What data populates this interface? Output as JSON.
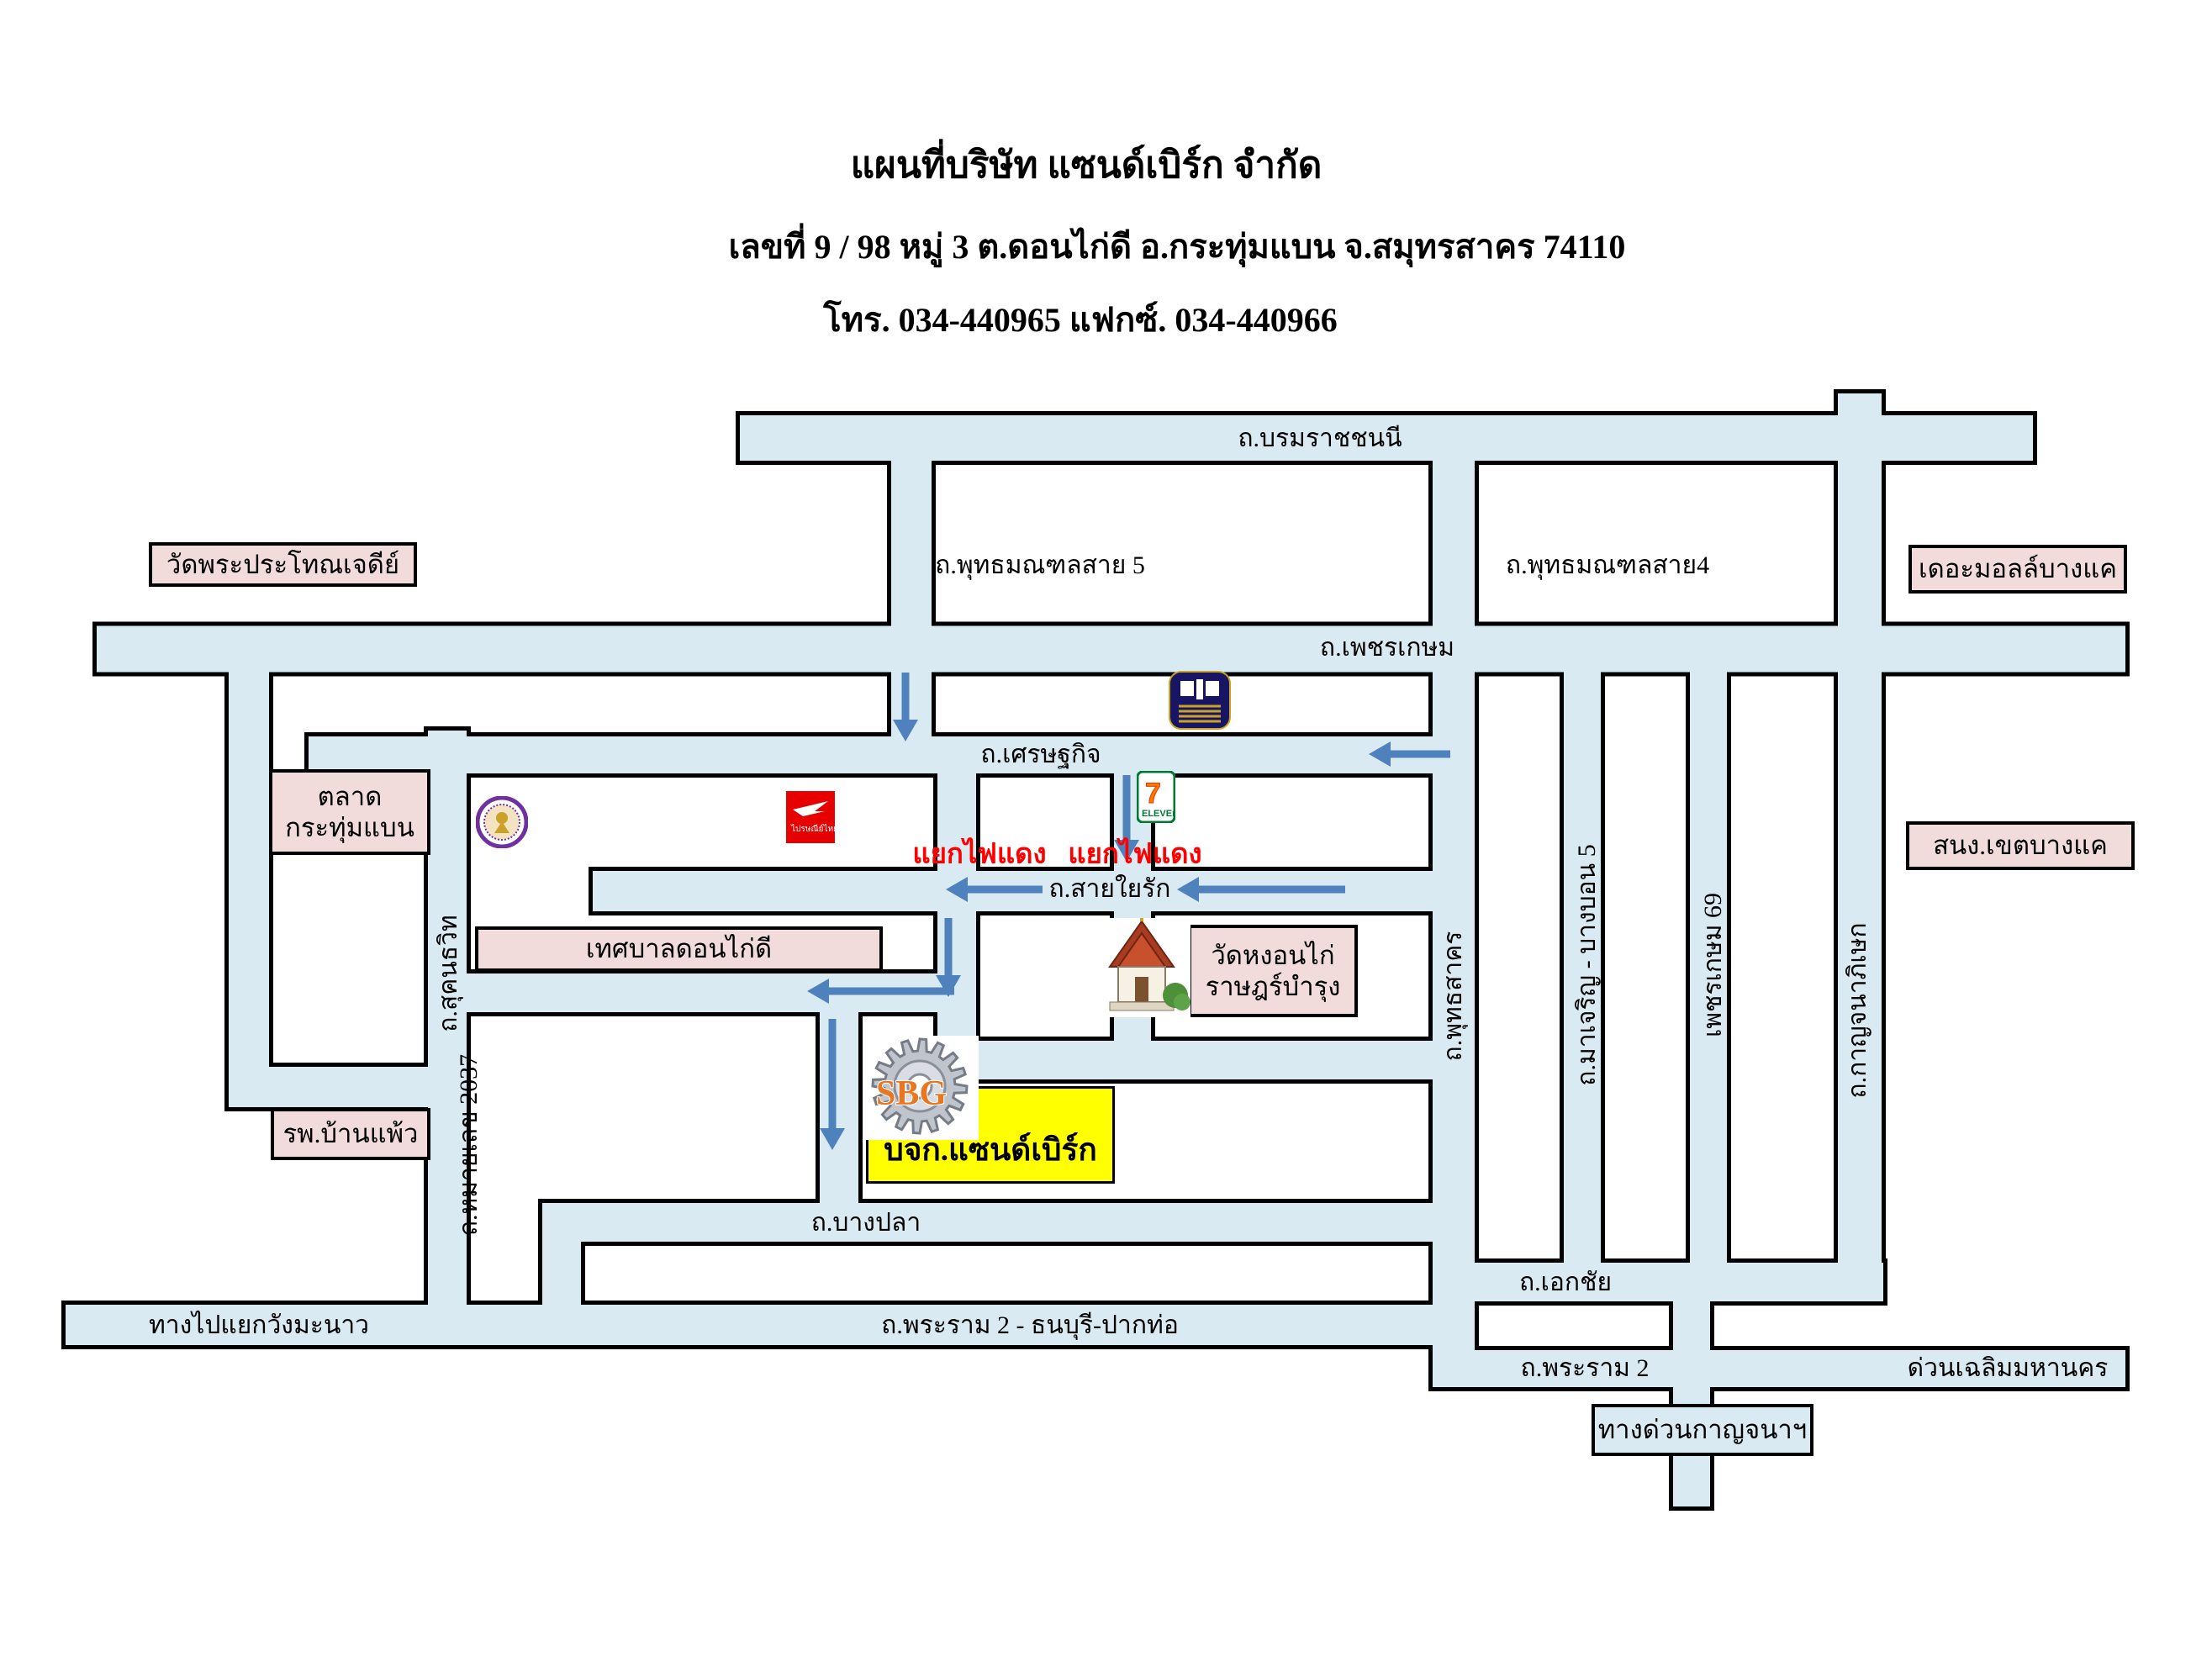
{
  "page": {
    "title_line1": "แผนที่บริษัท แซนด์เบิร์ก จำกัด",
    "title_line2": "เลขที่ 9 / 98   หมู่ 3   ต.ดอนไก่ดี  อ.กระทุ่มแบน  จ.สมุทรสาคร   74110",
    "title_line3": "โทร. 034-440965        แฟกซ์. 034-440966"
  },
  "company": {
    "name": "บจก.แซนด์เบิร์ก",
    "logo_text": "SBG"
  },
  "roads": {
    "borommaratchachonnani": "ถ.บรมราชชนนี",
    "phutthamonthon_sai5": "ถ.พุทธมณฑลสาย 5",
    "phutthamonthon_sai4": "ถ.พุทธมณฑลสาย4",
    "phetkasem": "ถ.เพชรเกษม",
    "setthakit": "ถ.เศรษฐกิจ",
    "saiyairak": "ถ.สายใยรัก",
    "bangpla": "ถ.บางปลา",
    "rama2_thonburi": "ถ.พระราม 2 - ธนบุรี-ปากท่อ",
    "wangmanao": "ทางไปแยกวังมะนาว",
    "ekkachai": "ถ.เอกชัย",
    "rama2": "ถ.พระราม 2",
    "chalerm_mahanakhon": "ด่วนเฉลิมมหานคร",
    "sukhonthawit": "ถ.สุคนธวิท",
    "highway2037": "ถ.หมายเลข 2037",
    "phutthasakhon": "ถ.พุทธสาคร",
    "macharoen": "ถ.มาเจริญ - บางบอน 5",
    "phetkasem69": "เพชรเกษม 69",
    "kanchanaphisek": "ถ.กาญจนาภิเษก"
  },
  "places": {
    "wat_phra_prathon": "วัดพระประโทณเจดีย์",
    "talat_line1": "ตลาด",
    "talat_line2": "กระทุ่มแบน",
    "thesaban_don_kai_di": "เทศบาลดอนไก่ดี",
    "wat_ngon_kai_line1": "วัดหงอนไก่",
    "wat_ngon_kai_line2": "ราษฎร์บำรุง",
    "banphaeo_hospital": "รพ.บ้านแพ้ว",
    "the_mall_bangkhae": "เดอะมอลล์บางแค",
    "bangkhae_district_office": "สนง.เขตบางแค",
    "kanchana_expressway": "ทางด่วนกาญจนาฯ"
  },
  "junctions": {
    "red_light_1": "แยกไฟแดง",
    "red_light_2": "แยกไฟแดง"
  },
  "logo_text": {
    "seven": "7",
    "eleven": "ELEVEn",
    "thailand_post": "ไปรษณีย์ไทย"
  },
  "icons": {
    "company_logo": "gear-icon",
    "bank": "bangkok-bank-logo",
    "convenience_store": "seven-eleven-logo",
    "post_office": "thailand-post-logo",
    "municipal_seal": "krathum-baen-seal-icon",
    "temple_image": "thai-temple-image"
  },
  "colors": {
    "road_fill": "#d9eaf2",
    "road_border": "#000000",
    "place_box_fill": "#f2dcdb",
    "company_box_fill": "#ffff00",
    "red_text": "#ff0000",
    "arrow_blue": "#4f81bd"
  }
}
